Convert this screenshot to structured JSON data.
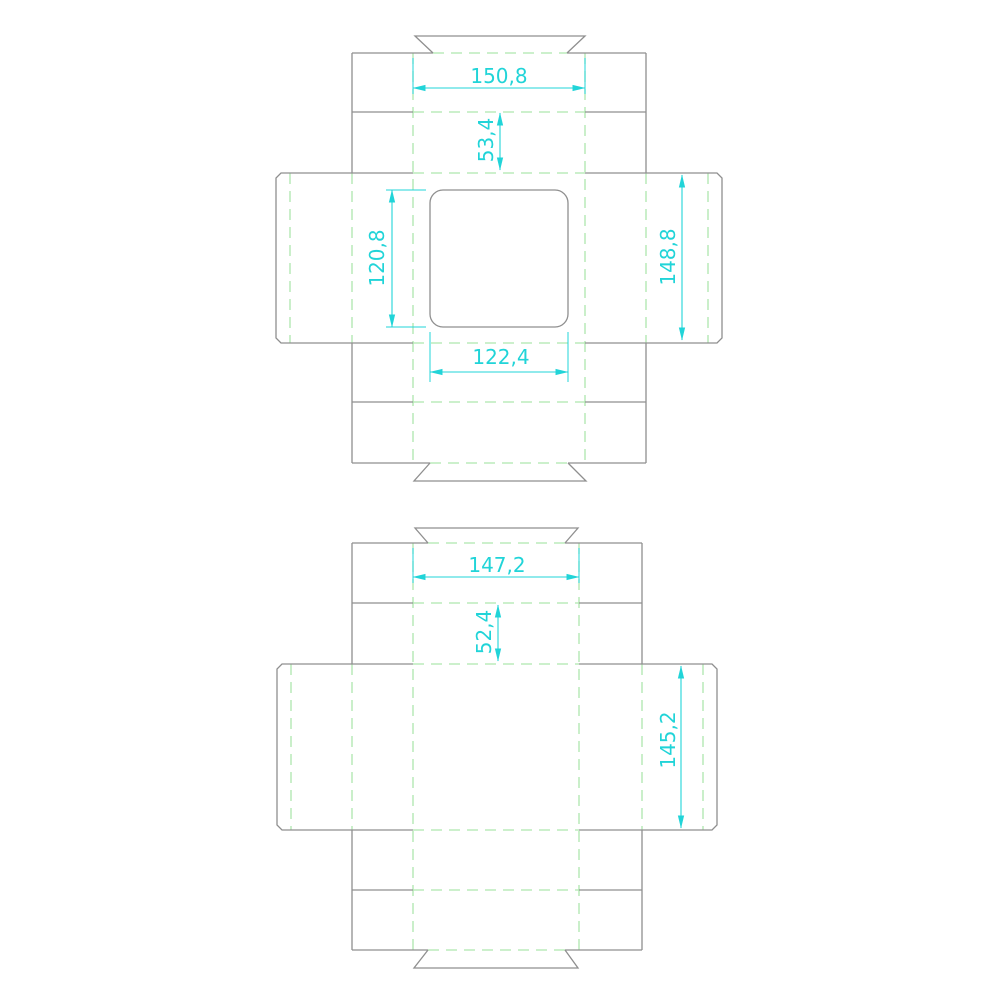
{
  "palette": {
    "background": "#ffffff",
    "cut_line": "#8f8f8f",
    "fold_line": "#aee6ae",
    "dimension": "#21d4d8"
  },
  "drawings": {
    "lid": {
      "name": "tray lid dieline with window cutout",
      "dims": {
        "top_flap_width": "150,8",
        "top_wall_depth": "53,4",
        "window_height": "120,8",
        "panel_height": "148,8",
        "window_width": "122,4"
      }
    },
    "base": {
      "name": "tray base dieline",
      "dims": {
        "top_flap_width": "147,2",
        "top_wall_depth": "52,4",
        "panel_height": "145,2"
      }
    }
  }
}
